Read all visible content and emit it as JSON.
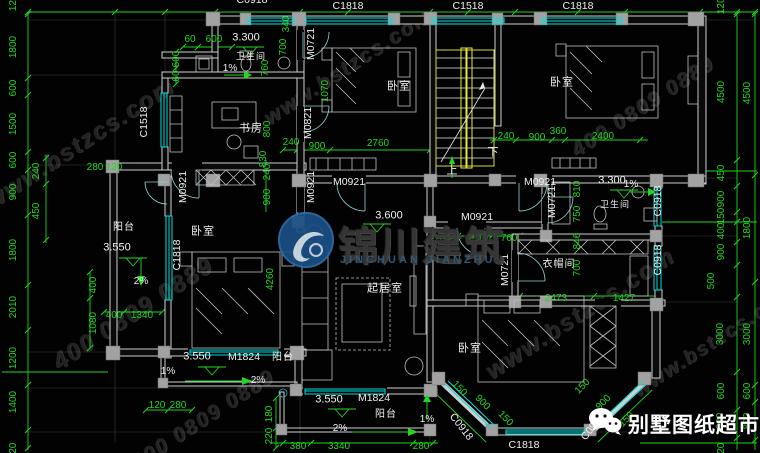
{
  "watermark": {
    "site": "www.bstzcs.com",
    "phone": "400 0809 0889",
    "logo_cn": "锦川建筑",
    "logo_en": "JINCHUAN JIANZHU"
  },
  "brand": {
    "name": "别墅图纸超市"
  },
  "labels": [
    {
      "t": "C0918",
      "x": 252,
      "y": 0,
      "c": "code"
    },
    {
      "t": "C1818",
      "x": 348,
      "y": 6,
      "c": "code"
    },
    {
      "t": "C1518",
      "x": 468,
      "y": 6,
      "c": "code"
    },
    {
      "t": "C1818",
      "x": 578,
      "y": 6,
      "c": "code"
    },
    {
      "t": "1200",
      "x": 14,
      "y": 0,
      "r": -90,
      "c": "g"
    },
    {
      "t": "1800",
      "x": 14,
      "y": 47,
      "r": -90,
      "c": "g"
    },
    {
      "t": "600",
      "x": 14,
      "y": 88,
      "r": -90,
      "c": "g"
    },
    {
      "t": "1500",
      "x": 14,
      "y": 124,
      "r": -90,
      "c": "g"
    },
    {
      "t": "600",
      "x": 14,
      "y": 160,
      "r": -90,
      "c": "g"
    },
    {
      "t": "900",
      "x": 14,
      "y": 192,
      "r": -90,
      "c": "g"
    },
    {
      "t": "1800",
      "x": 14,
      "y": 250,
      "r": -90,
      "c": "g"
    },
    {
      "t": "2010",
      "x": 14,
      "y": 307,
      "r": -90,
      "c": "g"
    },
    {
      "t": "1200",
      "x": 14,
      "y": 358,
      "r": -90,
      "c": "g"
    },
    {
      "t": "1400",
      "x": 14,
      "y": 402,
      "r": -90,
      "c": "g"
    },
    {
      "t": "120",
      "x": 14,
      "y": 451,
      "r": -90,
      "c": "g"
    },
    {
      "t": "240",
      "x": 37,
      "y": 171,
      "r": -90,
      "c": "g"
    },
    {
      "t": "450",
      "x": 37,
      "y": 211,
      "r": -90,
      "c": "g"
    },
    {
      "t": "1200",
      "x": 722,
      "y": 3,
      "r": -90,
      "c": "g"
    },
    {
      "t": "4500",
      "x": 722,
      "y": 92,
      "r": -90,
      "c": "g"
    },
    {
      "t": "450",
      "x": 722,
      "y": 173,
      "r": -90,
      "c": "g"
    },
    {
      "t": "900",
      "x": 722,
      "y": 199,
      "r": -90,
      "c": "g"
    },
    {
      "t": "150",
      "x": 722,
      "y": 216,
      "r": -90,
      "c": "g"
    },
    {
      "t": "400",
      "x": 722,
      "y": 231,
      "r": -90,
      "c": "g"
    },
    {
      "t": "900",
      "x": 722,
      "y": 252,
      "r": -90,
      "c": "g"
    },
    {
      "t": "500",
      "x": 712,
      "y": 281,
      "r": -90,
      "c": "g"
    },
    {
      "t": "3000",
      "x": 721,
      "y": 334,
      "r": -90,
      "c": "g"
    },
    {
      "t": "600",
      "x": 722,
      "y": 391,
      "r": -90,
      "c": "g"
    },
    {
      "t": "800",
      "x": 721,
      "y": 421,
      "r": -90,
      "c": "g"
    },
    {
      "t": "120",
      "x": 722,
      "y": 451,
      "r": -90,
      "c": "g"
    },
    {
      "t": "4500",
      "x": 748,
      "y": 93,
      "r": -90,
      "c": "g"
    },
    {
      "t": "1800",
      "x": 748,
      "y": 228,
      "r": -90,
      "c": "g"
    },
    {
      "t": "3000",
      "x": 748,
      "y": 334,
      "r": -90,
      "c": "g"
    },
    {
      "t": "600",
      "x": 748,
      "y": 391,
      "r": -90,
      "c": "g"
    },
    {
      "t": "800",
      "x": 748,
      "y": 421,
      "r": -90,
      "c": "g"
    },
    {
      "t": "60",
      "x": 190,
      "y": 40,
      "c": "g"
    },
    {
      "t": "600",
      "x": 214,
      "y": 40,
      "c": "g"
    },
    {
      "t": "600",
      "x": 177,
      "y": 59,
      "r": -90,
      "c": "g"
    },
    {
      "t": "60",
      "x": 177,
      "y": 76,
      "r": -90,
      "c": "g"
    },
    {
      "t": "3.300",
      "x": 246,
      "y": 38,
      "c": "lvl"
    },
    {
      "t": "卫生间",
      "x": 251,
      "y": 57,
      "c": "rm",
      "s": 9
    },
    {
      "t": "1%",
      "x": 230,
      "y": 69,
      "c": "w"
    },
    {
      "t": "340",
      "x": 287,
      "y": 24,
      "r": -90,
      "c": "g"
    },
    {
      "t": "700",
      "x": 284,
      "y": 47,
      "r": -90,
      "c": "g"
    },
    {
      "t": "760",
      "x": 266,
      "y": 68,
      "r": -90,
      "c": "g"
    },
    {
      "t": "M0721",
      "x": 311,
      "y": 44,
      "r": -90,
      "c": "code"
    },
    {
      "t": "1070",
      "x": 326,
      "y": 91,
      "r": -90,
      "c": "g"
    },
    {
      "t": "C1518",
      "x": 144,
      "y": 122,
      "r": -90,
      "c": "code"
    },
    {
      "t": "书房",
      "x": 251,
      "y": 129,
      "c": "rm"
    },
    {
      "t": "800",
      "x": 268,
      "y": 129,
      "r": -90,
      "c": "g"
    },
    {
      "t": "M0821",
      "x": 308,
      "y": 123,
      "r": -90,
      "c": "code"
    },
    {
      "t": "240",
      "x": 291,
      "y": 143,
      "c": "g"
    },
    {
      "t": "900",
      "x": 317,
      "y": 147,
      "c": "g"
    },
    {
      "t": "2760",
      "x": 378,
      "y": 144,
      "c": "g"
    },
    {
      "t": "830",
      "x": 264,
      "y": 159,
      "r": -90,
      "c": "g"
    },
    {
      "t": "280",
      "x": 95,
      "y": 168,
      "c": "g"
    },
    {
      "t": "120",
      "x": 114,
      "y": 168,
      "c": "g"
    },
    {
      "t": "M0921",
      "x": 183,
      "y": 187,
      "r": -90,
      "c": "code"
    },
    {
      "t": "M0921",
      "x": 311,
      "y": 187,
      "r": -90,
      "c": "code"
    },
    {
      "t": "240",
      "x": 268,
      "y": 172,
      "r": -90,
      "c": "g"
    },
    {
      "t": "900",
      "x": 268,
      "y": 197,
      "r": -90,
      "c": "g"
    },
    {
      "t": "M0921",
      "x": 349,
      "y": 182,
      "c": "code"
    },
    {
      "t": "M0921",
      "x": 540,
      "y": 182,
      "c": "code"
    },
    {
      "t": "卧室",
      "x": 399,
      "y": 87,
      "c": "rm"
    },
    {
      "t": "卧室",
      "x": 562,
      "y": 83,
      "c": "rm"
    },
    {
      "t": "240",
      "x": 506,
      "y": 137,
      "c": "g"
    },
    {
      "t": "900",
      "x": 537,
      "y": 138,
      "c": "g"
    },
    {
      "t": "360",
      "x": 558,
      "y": 132,
      "c": "g"
    },
    {
      "t": "2400",
      "x": 603,
      "y": 137,
      "c": "g"
    },
    {
      "t": "下",
      "x": 493,
      "y": 153,
      "c": "w",
      "s": 11
    },
    {
      "t": "上",
      "x": 452,
      "y": 171,
      "c": "w",
      "s": 11
    },
    {
      "t": "M0721",
      "x": 552,
      "y": 202,
      "r": -90,
      "c": "code"
    },
    {
      "t": "810",
      "x": 578,
      "y": 189,
      "r": -90,
      "c": "g"
    },
    {
      "t": "3.300",
      "x": 612,
      "y": 181,
      "c": "lvl"
    },
    {
      "t": "1%",
      "x": 631,
      "y": 185,
      "c": "w"
    },
    {
      "t": "卫生间",
      "x": 615,
      "y": 205,
      "c": "rm",
      "s": 9
    },
    {
      "t": "750",
      "x": 578,
      "y": 214,
      "r": -90,
      "c": "g"
    },
    {
      "t": "C0918",
      "x": 658,
      "y": 201,
      "r": -90,
      "c": "code"
    },
    {
      "t": "C0918",
      "x": 658,
      "y": 260,
      "r": -90,
      "c": "code"
    },
    {
      "t": "3.600",
      "x": 389,
      "y": 216,
      "c": "lvl"
    },
    {
      "t": "M0921",
      "x": 477,
      "y": 217,
      "c": "code"
    },
    {
      "t": "1040",
      "x": 445,
      "y": 239,
      "c": "g"
    },
    {
      "t": "900",
      "x": 477,
      "y": 239,
      "c": "g"
    },
    {
      "t": "760",
      "x": 509,
      "y": 239,
      "c": "g"
    },
    {
      "t": "M0721",
      "x": 505,
      "y": 270,
      "r": -90,
      "c": "code"
    },
    {
      "t": "衣帽间",
      "x": 559,
      "y": 265,
      "c": "rm",
      "s": 10
    },
    {
      "t": "846",
      "x": 578,
      "y": 241,
      "r": -90,
      "c": "g"
    },
    {
      "t": "700",
      "x": 578,
      "y": 268,
      "r": -90,
      "c": "g"
    },
    {
      "t": "2473",
      "x": 556,
      "y": 299,
      "c": "g"
    },
    {
      "t": "1427",
      "x": 624,
      "y": 299,
      "c": "g"
    },
    {
      "t": "起居室",
      "x": 385,
      "y": 289,
      "c": "rm"
    },
    {
      "t": "卧室",
      "x": 470,
      "y": 349,
      "c": "rm"
    },
    {
      "t": "阳台",
      "x": 124,
      "y": 228,
      "c": "rm",
      "s": 10
    },
    {
      "t": "3.550",
      "x": 117,
      "y": 248,
      "c": "lvl"
    },
    {
      "t": "2%",
      "x": 141,
      "y": 282,
      "c": "w"
    },
    {
      "t": "C1818",
      "x": 177,
      "y": 255,
      "r": -90,
      "c": "code"
    },
    {
      "t": "卧室",
      "x": 203,
      "y": 232,
      "c": "rm"
    },
    {
      "t": "4260",
      "x": 271,
      "y": 279,
      "r": -90,
      "c": "g"
    },
    {
      "t": "400",
      "x": 94,
      "y": 285,
      "r": -90,
      "c": "g"
    },
    {
      "t": "1080",
      "x": 94,
      "y": 323,
      "r": -90,
      "c": "g"
    },
    {
      "t": "400",
      "x": 114,
      "y": 316,
      "c": "g"
    },
    {
      "t": "1340",
      "x": 142,
      "y": 316,
      "c": "g"
    },
    {
      "t": "3.550",
      "x": 197,
      "y": 357,
      "c": "lvl"
    },
    {
      "t": "M1824",
      "x": 244,
      "y": 357,
      "c": "code"
    },
    {
      "t": "阳台",
      "x": 283,
      "y": 358,
      "c": "rm",
      "s": 10
    },
    {
      "t": "1%",
      "x": 168,
      "y": 372,
      "c": "w"
    },
    {
      "t": "2%",
      "x": 258,
      "y": 381,
      "c": "w"
    },
    {
      "t": "120",
      "x": 157,
      "y": 406,
      "c": "g"
    },
    {
      "t": "280",
      "x": 178,
      "y": 406,
      "c": "g"
    },
    {
      "t": "180",
      "x": 270,
      "y": 414,
      "r": -90,
      "c": "g"
    },
    {
      "t": "220",
      "x": 270,
      "y": 436,
      "r": -90,
      "c": "g"
    },
    {
      "t": "3.550",
      "x": 329,
      "y": 400,
      "c": "lvl"
    },
    {
      "t": "M1824",
      "x": 374,
      "y": 398,
      "c": "code"
    },
    {
      "t": "阳台",
      "x": 386,
      "y": 415,
      "c": "rm",
      "s": 10
    },
    {
      "t": "2%",
      "x": 340,
      "y": 429,
      "c": "w"
    },
    {
      "t": "1%",
      "x": 427,
      "y": 420,
      "c": "w"
    },
    {
      "t": "380",
      "x": 298,
      "y": 447,
      "c": "g"
    },
    {
      "t": "3340",
      "x": 339,
      "y": 447,
      "c": "g"
    },
    {
      "t": "280",
      "x": 421,
      "y": 447,
      "c": "g"
    },
    {
      "t": "C1818",
      "x": 524,
      "y": 445,
      "c": "code"
    },
    {
      "t": "C0918",
      "x": 461,
      "y": 427,
      "r": 52,
      "c": "code"
    },
    {
      "t": "C0918",
      "x": 593,
      "y": 427,
      "r": -52,
      "c": "code"
    },
    {
      "t": "150",
      "x": 459,
      "y": 389,
      "r": 46,
      "c": "g"
    },
    {
      "t": "900",
      "x": 482,
      "y": 403,
      "r": 46,
      "c": "g"
    },
    {
      "t": "150",
      "x": 505,
      "y": 419,
      "r": 46,
      "c": "g"
    },
    {
      "t": "150",
      "x": 583,
      "y": 387,
      "r": -46,
      "c": "g"
    },
    {
      "t": "900",
      "x": 604,
      "y": 403,
      "r": -46,
      "c": "g"
    },
    {
      "t": "150",
      "x": 627,
      "y": 420,
      "r": -46,
      "c": "g"
    }
  ]
}
